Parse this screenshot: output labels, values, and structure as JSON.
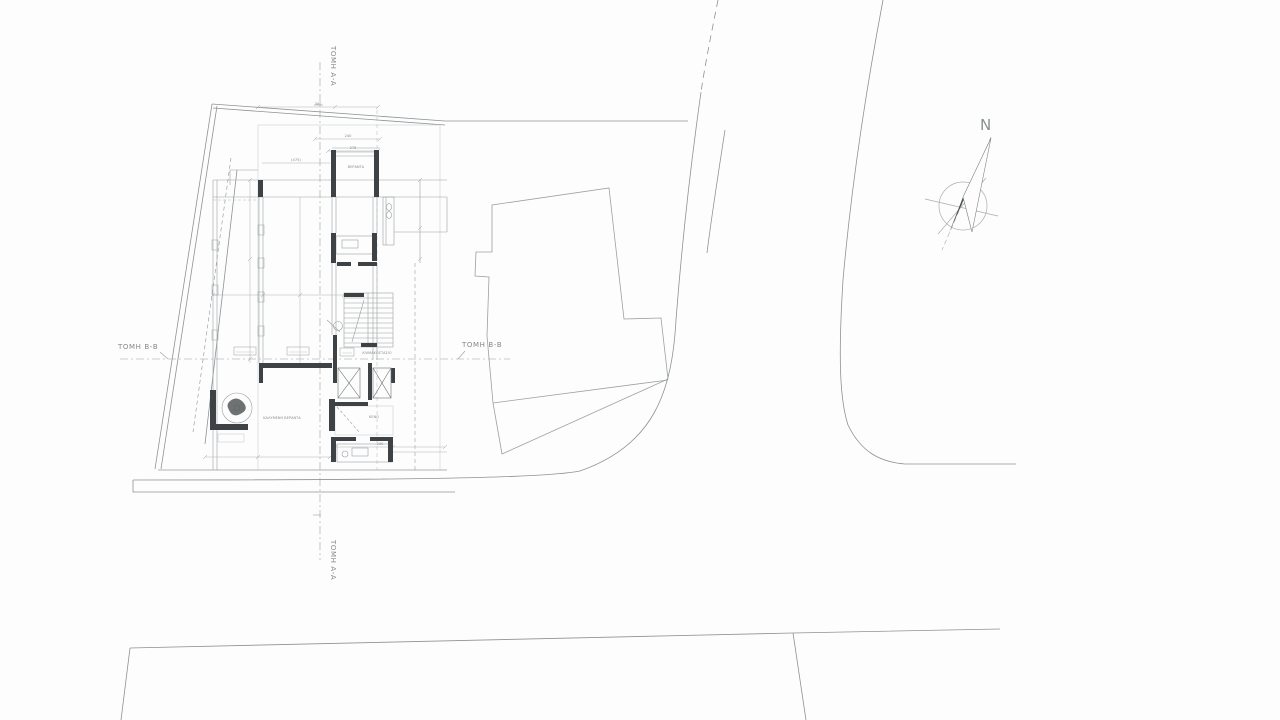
{
  "drawing": {
    "title": "Site plan — ground floor architectural drawing"
  },
  "colors": {
    "background": "#fdfdfd",
    "thin_line": "#9ba0a2",
    "light_line": "#c2c6c8",
    "boundary_line": "#7d8284",
    "wall_fill": "#3f4244",
    "text": "#85898b"
  },
  "sections": {
    "aa_top": "ΤΟΜΗ Α-Α",
    "aa_bottom": "ΤΟΜΗ Α-Α",
    "bb_left": "ΤΟΜΗ Β-Β",
    "bb_right": "ΤΟΜΗ Β-Β"
  },
  "compass": {
    "north": "N"
  },
  "plan": {
    "room_labels": [
      {
        "text": "ΒΕΡΑΝΤΑ"
      },
      {
        "text": "ΚΛΙΜΑΚΟΣΤΑΣΙΟ"
      },
      {
        "text": "ΚΑΛΥΜΕΝΗ ΒΕΡΑΝΤΑ"
      },
      {
        "text": "ΚΕΝΟ"
      }
    ],
    "dims": [
      {
        "value": "300"
      },
      {
        "value": "240"
      },
      {
        "value": "275"
      },
      {
        "value": "(475)"
      },
      {
        "value": "240"
      }
    ]
  }
}
